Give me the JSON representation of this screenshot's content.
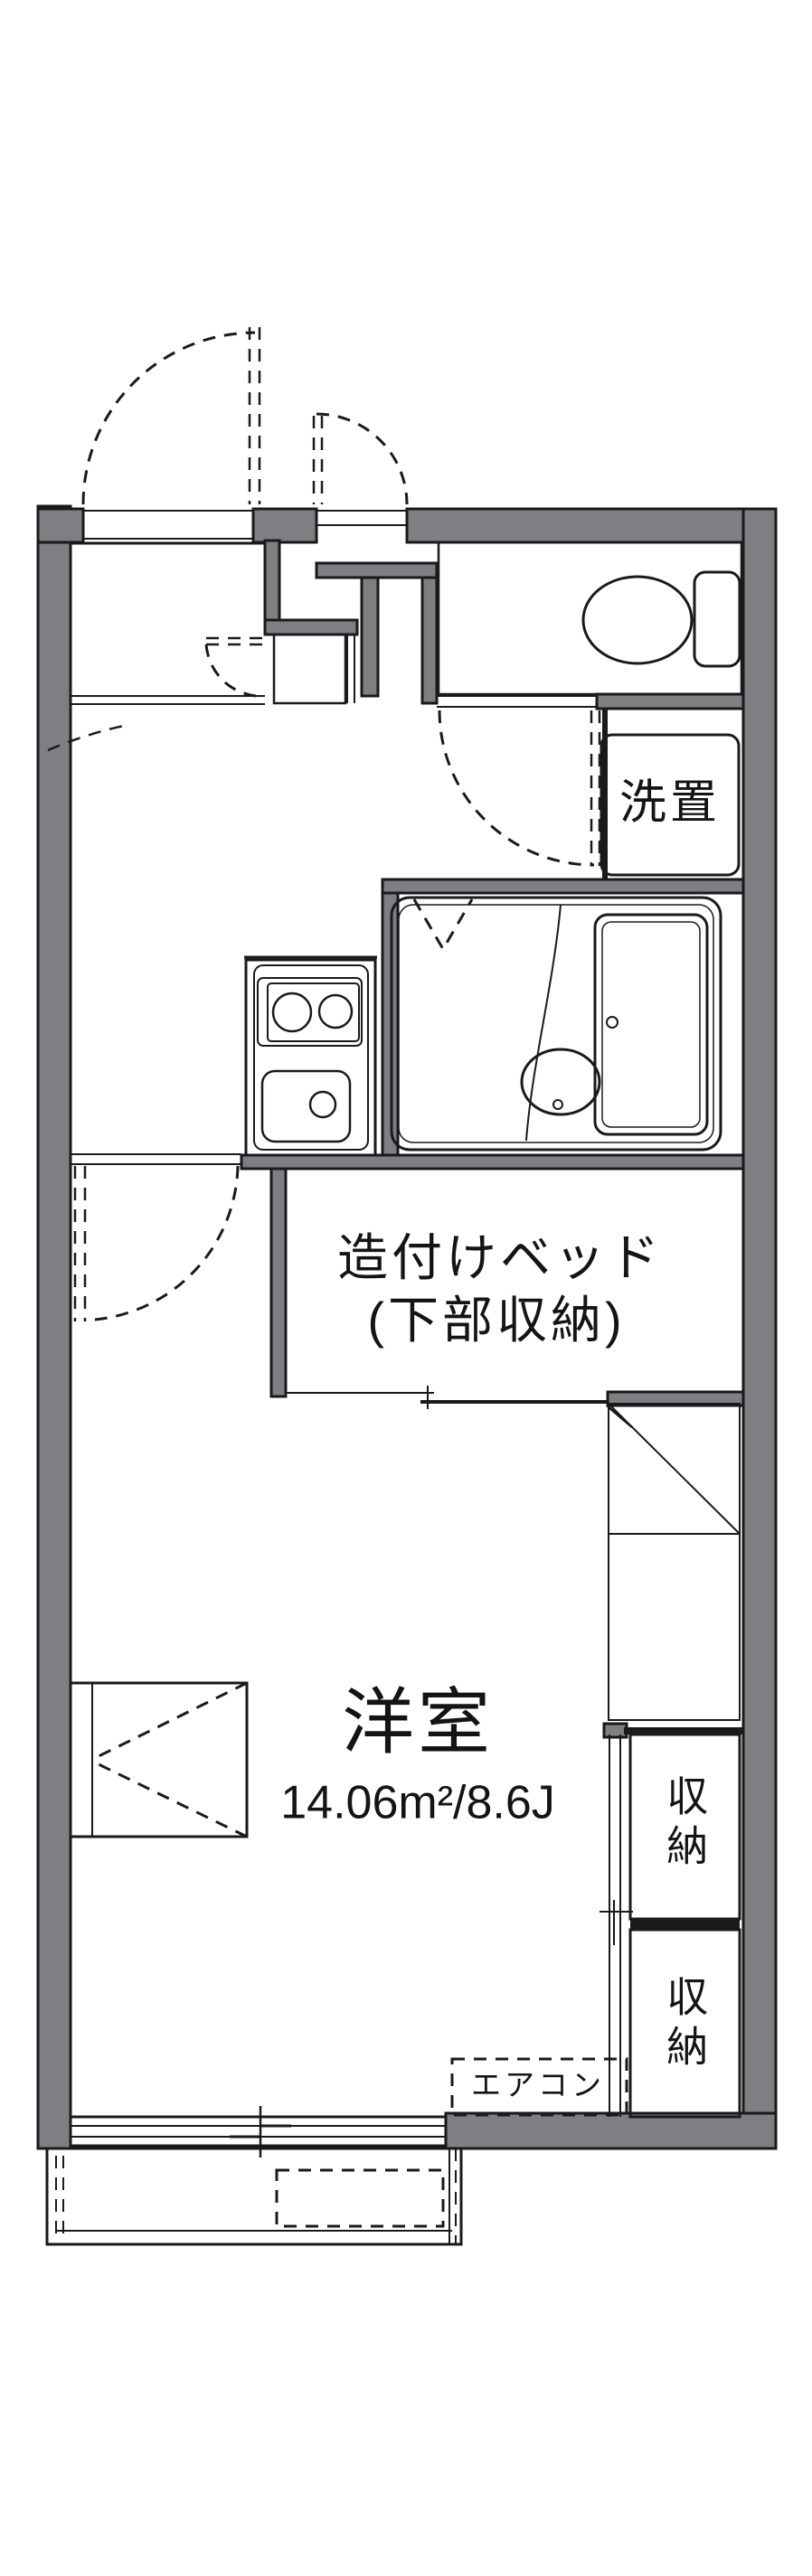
{
  "floorplan": {
    "labels": {
      "washer": "洗置",
      "bed_line1": "造付けベッド",
      "bed_line2": "(下部収納)",
      "room_name": "洋室",
      "room_area": "14.06m²/8.6J",
      "closet_upper": "収納",
      "closet_lower": "収納",
      "aircon": "エアコン"
    },
    "colors": {
      "wall_gray": "#7e7e83",
      "water_blue": "#e5edfb",
      "tile_beige": "#fbf2e0",
      "line_black": "#1a1a1a",
      "background": "#ffffff"
    }
  }
}
